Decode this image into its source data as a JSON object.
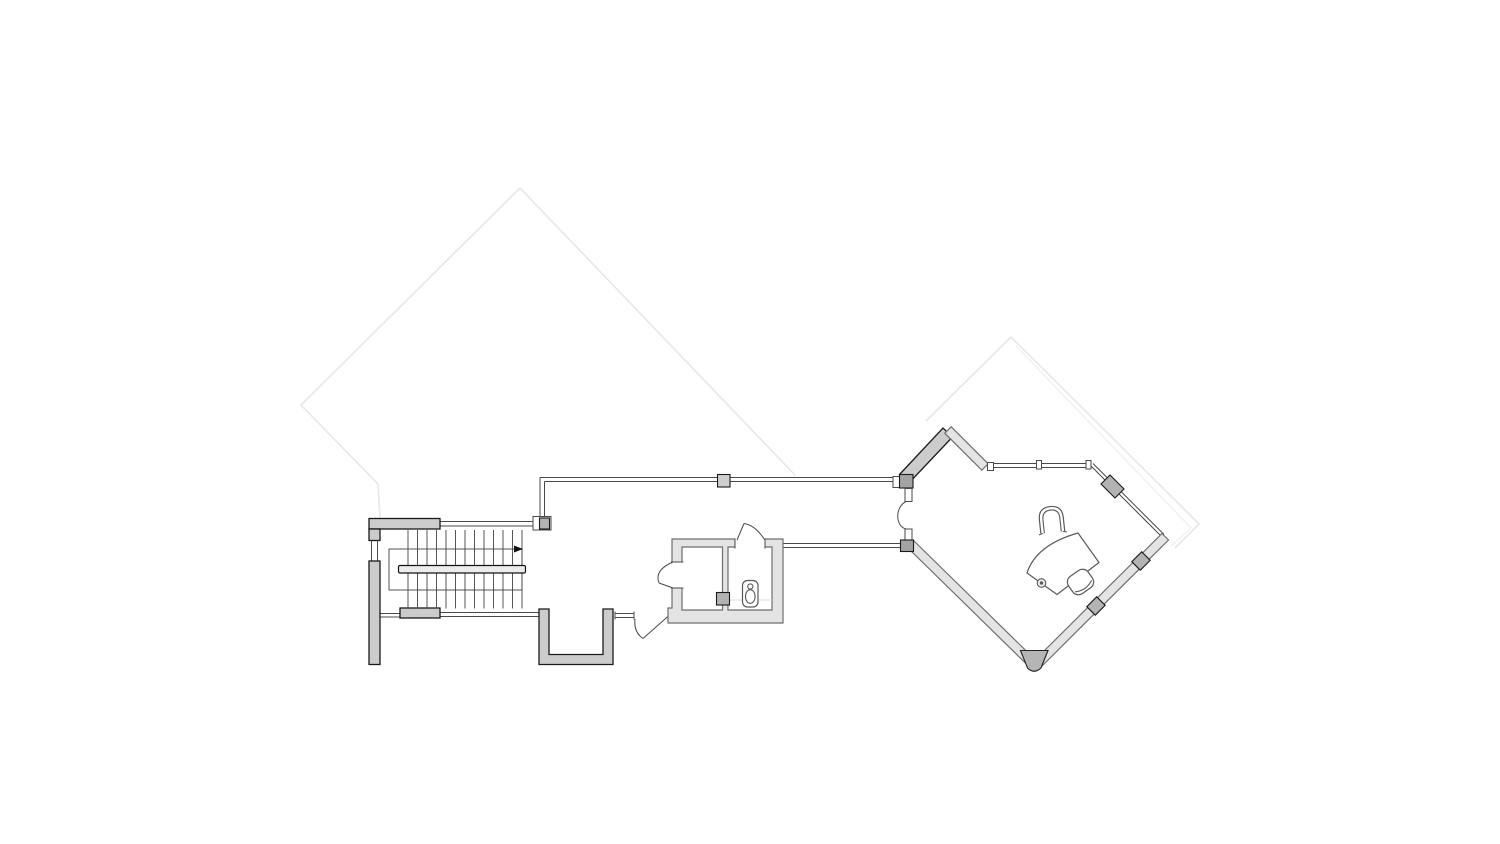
{
  "drawing": {
    "kind": "architectural-floor-plan",
    "rooms": [
      "stair-hall",
      "corridor",
      "wc-lobby",
      "wc",
      "office"
    ],
    "stair": {
      "tread_count": 13,
      "tread_start_x": 408,
      "tread_step_x": 9.5,
      "tread_top_y": 530,
      "tread_bottom_y": 608.5,
      "handrail": true,
      "direction_arrow": true
    },
    "fixtures": [
      "toilet"
    ],
    "furniture": [
      "office-chair",
      "curved-desk",
      "desk-grommet",
      "stool"
    ],
    "doors": [
      "wc-lobby-side-door",
      "wc-top-door",
      "corridor-door",
      "office-entry-door"
    ],
    "glazing_runs": 8,
    "faint_outline": "projection of floor/roof below"
  },
  "colors": {
    "background": "#ffffff",
    "wall_fill": "#cccccc",
    "wall_stroke": "#1a1a1a",
    "light_wall_fill": "#e4e4e4",
    "light_wall_stroke": "#6e6e6e",
    "block_fill": "#b3b3b3",
    "glazing_stroke": "#4a4a4a",
    "stair_line": "#444444",
    "faint_outline": "#e7e7e9",
    "faint_outline_inner": "#f1f1f3",
    "furniture_stroke": "#5a5a5a",
    "handrail_fill": "#ececec",
    "accent_dark": "#111111"
  }
}
